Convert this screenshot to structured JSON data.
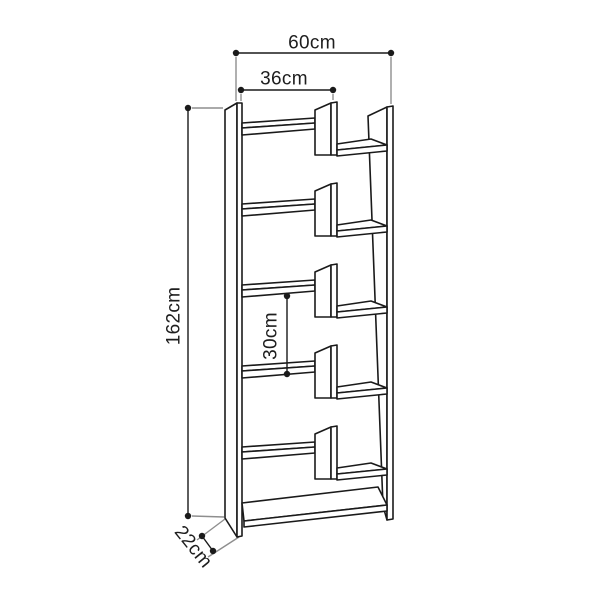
{
  "diagram": {
    "background_color": "#ffffff",
    "outline_color": "#1a1a1a",
    "extension_line_color": "#8e8e8e",
    "label_color": "#1e1e1e",
    "labels": {
      "overall_width": "60cm",
      "inner_width": "36cm",
      "overall_height": "162cm",
      "shelf_gap": "30cm",
      "depth": "22cm"
    }
  }
}
